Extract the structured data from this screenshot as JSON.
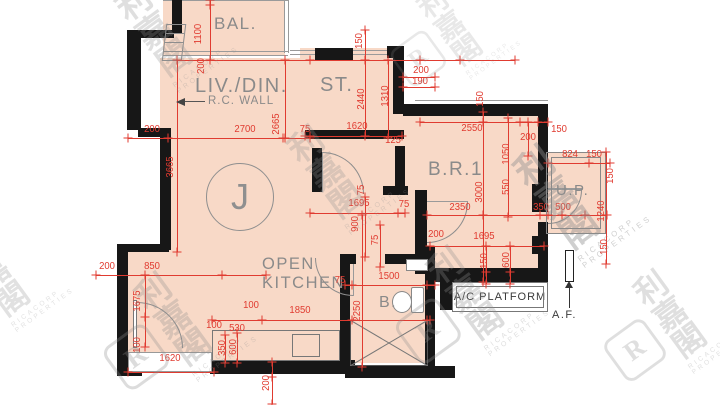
{
  "unit": {
    "label": "J"
  },
  "rooms": {
    "balcony": "BAL.",
    "living_dining": "LIV./DIN.",
    "rc_wall": "R.C. WALL",
    "store": "ST.",
    "bedroom1": "B.R.1",
    "utility_platform": "U.P.",
    "kitchen_line1": "OPEN",
    "kitchen_line2": "KITCHEN",
    "bathroom": "B.",
    "ac_platform": "A/C PLATFORM",
    "acoustic_fin": "A.F."
  },
  "colors": {
    "floor_fill": "#f8d9c7",
    "dimension_red": "#e03b30",
    "wall": "#171717",
    "label_gray": "#8a8a8a"
  },
  "dimensions": [
    {
      "t": "1100",
      "x": 199,
      "y": 34,
      "r": 90
    },
    {
      "t": "200",
      "x": 202,
      "y": 66,
      "r": 90
    },
    {
      "t": "200",
      "x": 152,
      "y": 130,
      "r": 0
    },
    {
      "t": "2700",
      "x": 245,
      "y": 130,
      "r": 0
    },
    {
      "t": "2665",
      "x": 277,
      "y": 124,
      "r": 90
    },
    {
      "t": "75",
      "x": 305,
      "y": 130,
      "r": 0
    },
    {
      "t": "3665",
      "x": 171,
      "y": 167,
      "r": 90
    },
    {
      "t": "150",
      "x": 360,
      "y": 41,
      "r": 90
    },
    {
      "t": "2440",
      "x": 362,
      "y": 99,
      "r": 90
    },
    {
      "t": "1310",
      "x": 386,
      "y": 96,
      "r": 90
    },
    {
      "t": "1620",
      "x": 357,
      "y": 127,
      "r": 0
    },
    {
      "t": "125",
      "x": 393,
      "y": 141,
      "r": 0
    },
    {
      "t": "200",
      "x": 421,
      "y": 71,
      "r": 0
    },
    {
      "t": "190",
      "x": 420,
      "y": 82,
      "r": 0
    },
    {
      "t": "2550",
      "x": 472,
      "y": 129,
      "r": 0
    },
    {
      "t": "150",
      "x": 481,
      "y": 99,
      "r": 90
    },
    {
      "t": "150",
      "x": 559,
      "y": 130,
      "r": 0
    },
    {
      "t": "200",
      "x": 528,
      "y": 138,
      "r": 0
    },
    {
      "t": "1050",
      "x": 507,
      "y": 154,
      "r": 90
    },
    {
      "t": "824",
      "x": 570,
      "y": 155,
      "r": 0
    },
    {
      "t": "150",
      "x": 594,
      "y": 155,
      "r": 0
    },
    {
      "t": "150",
      "x": 611,
      "y": 176,
      "r": 90
    },
    {
      "t": "1240",
      "x": 602,
      "y": 211,
      "r": 90
    },
    {
      "t": "150",
      "x": 605,
      "y": 247,
      "r": 90
    },
    {
      "t": "550",
      "x": 507,
      "y": 187,
      "r": 90
    },
    {
      "t": "3000",
      "x": 480,
      "y": 192,
      "r": 90
    },
    {
      "t": "2350",
      "x": 460,
      "y": 208,
      "r": 0
    },
    {
      "t": "350",
      "x": 541,
      "y": 208,
      "r": 0
    },
    {
      "t": "500",
      "x": 563,
      "y": 208,
      "r": 0
    },
    {
      "t": "75",
      "x": 362,
      "y": 190,
      "r": 90
    },
    {
      "t": "1695",
      "x": 359,
      "y": 204,
      "r": 0
    },
    {
      "t": "75",
      "x": 404,
      "y": 205,
      "r": 0
    },
    {
      "t": "900",
      "x": 356,
      "y": 224,
      "r": 90
    },
    {
      "t": "75",
      "x": 376,
      "y": 240,
      "r": 90
    },
    {
      "t": "200",
      "x": 436,
      "y": 235,
      "r": 0
    },
    {
      "t": "1695",
      "x": 484,
      "y": 237,
      "r": 0
    },
    {
      "t": "150",
      "x": 485,
      "y": 261,
      "r": 90
    },
    {
      "t": "600",
      "x": 507,
      "y": 260,
      "r": 90
    },
    {
      "t": "2250",
      "x": 358,
      "y": 311,
      "r": 90
    },
    {
      "t": "1500",
      "x": 389,
      "y": 277,
      "r": 0
    },
    {
      "t": "75",
      "x": 340,
      "y": 281,
      "r": 0
    },
    {
      "t": "200",
      "x": 107,
      "y": 267,
      "r": 0
    },
    {
      "t": "850",
      "x": 152,
      "y": 267,
      "r": 0
    },
    {
      "t": "1675",
      "x": 138,
      "y": 301,
      "r": 90
    },
    {
      "t": "100",
      "x": 138,
      "y": 345,
      "r": 90
    },
    {
      "t": "1620",
      "x": 170,
      "y": 359,
      "r": 0
    },
    {
      "t": "100",
      "x": 214,
      "y": 326,
      "r": 0
    },
    {
      "t": "530",
      "x": 237,
      "y": 329,
      "r": 0
    },
    {
      "t": "100",
      "x": 251,
      "y": 306,
      "r": 0
    },
    {
      "t": "1850",
      "x": 300,
      "y": 311,
      "r": 0
    },
    {
      "t": "350",
      "x": 223,
      "y": 348,
      "r": 90
    },
    {
      "t": "600",
      "x": 234,
      "y": 347,
      "r": 90
    },
    {
      "t": "200",
      "x": 267,
      "y": 383,
      "r": 90
    }
  ],
  "watermark": {
    "cjk": "利嘉閣",
    "latin": "RICACORP PROPERTIES",
    "logo_letter": "R",
    "positions": [
      {
        "x": 180,
        "y": 95,
        "logo": false,
        "s": 1,
        "a": 0.28
      },
      {
        "x": 352,
        "y": 237,
        "logo": false,
        "s": 1,
        "a": 0.28
      },
      {
        "x": 586,
        "y": 270,
        "logo": false,
        "s": 1.12,
        "a": 0.42
      },
      {
        "x": 18,
        "y": 334,
        "logo": false,
        "s": 0.95,
        "a": 0.26
      },
      {
        "x": 150,
        "y": 420,
        "logo": true,
        "s": 1,
        "a": 0.3
      },
      {
        "x": 442,
        "y": 394,
        "logo": true,
        "s": 1,
        "a": 0.3
      },
      {
        "x": 648,
        "y": 410,
        "logo": true,
        "s": 0.95,
        "a": 0.28
      },
      {
        "x": 430,
        "y": 112,
        "logo": true,
        "s": 0.85,
        "a": 0.2
      }
    ]
  }
}
